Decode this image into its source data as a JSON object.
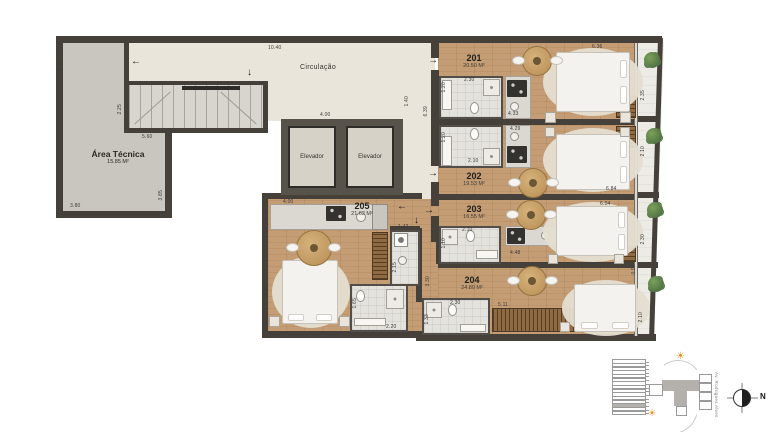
{
  "plan": {
    "circulation": "Circulação",
    "area_tecnica": {
      "label": "Área Técnica",
      "area": "15.85 M²"
    },
    "elevator": "Elevador",
    "units": {
      "u201": {
        "id": "201",
        "area": "20.50 M²"
      },
      "u202": {
        "id": "202",
        "area": "19.53 M²"
      },
      "u203": {
        "id": "203",
        "area": "16.55 M²"
      },
      "u204": {
        "id": "204",
        "area": "24.80 M²"
      },
      "u205": {
        "id": "205",
        "area": "21.62 M²"
      }
    },
    "dims": {
      "left_height": "5.45",
      "top_width": "10.40",
      "stair_wall": "2.25",
      "at_step": "5.60",
      "at_bottom": "3.80",
      "at_right": "3.85",
      "hall_width": "4.00",
      "corridor_width": "1.40",
      "corridor_length": "6.39",
      "u201_top": "6.36",
      "u201_bath_h": "1.20",
      "u201_bath_w": "2.30",
      "u201_kitchen": "4.33",
      "u201_balcony": "2.35",
      "u202_bath_h": "1.20",
      "u202_bath_w": "2.10",
      "u202_kitchen": "4.29",
      "u202_balcony": "2.10",
      "u202_bottom": "6.84",
      "u203_top": "6.04",
      "u203_bath_w": "2.10",
      "u203_bath_h": "1.10",
      "u203_kitchen": "4.48",
      "u203_balcony": "2.30",
      "u203_edge": "0.95",
      "u204_left": "3.30",
      "u204_bath_w": "2.30",
      "u204_bath_h": "1.33",
      "u204_closet": "5.11",
      "u204_balcony": "2.10",
      "u205_kitchen": "4.00",
      "u205_hall": "1.42",
      "u205_bed": "4.40",
      "u205_bath_h": "2.15",
      "u205_bath2_h": "1.65",
      "u205_bath2_w": "2.20"
    },
    "arrows": {
      "left": "←",
      "right": "→",
      "down": "↓"
    }
  },
  "legend": {
    "street": "Av. Rodrigues Alves",
    "north": "N"
  }
}
